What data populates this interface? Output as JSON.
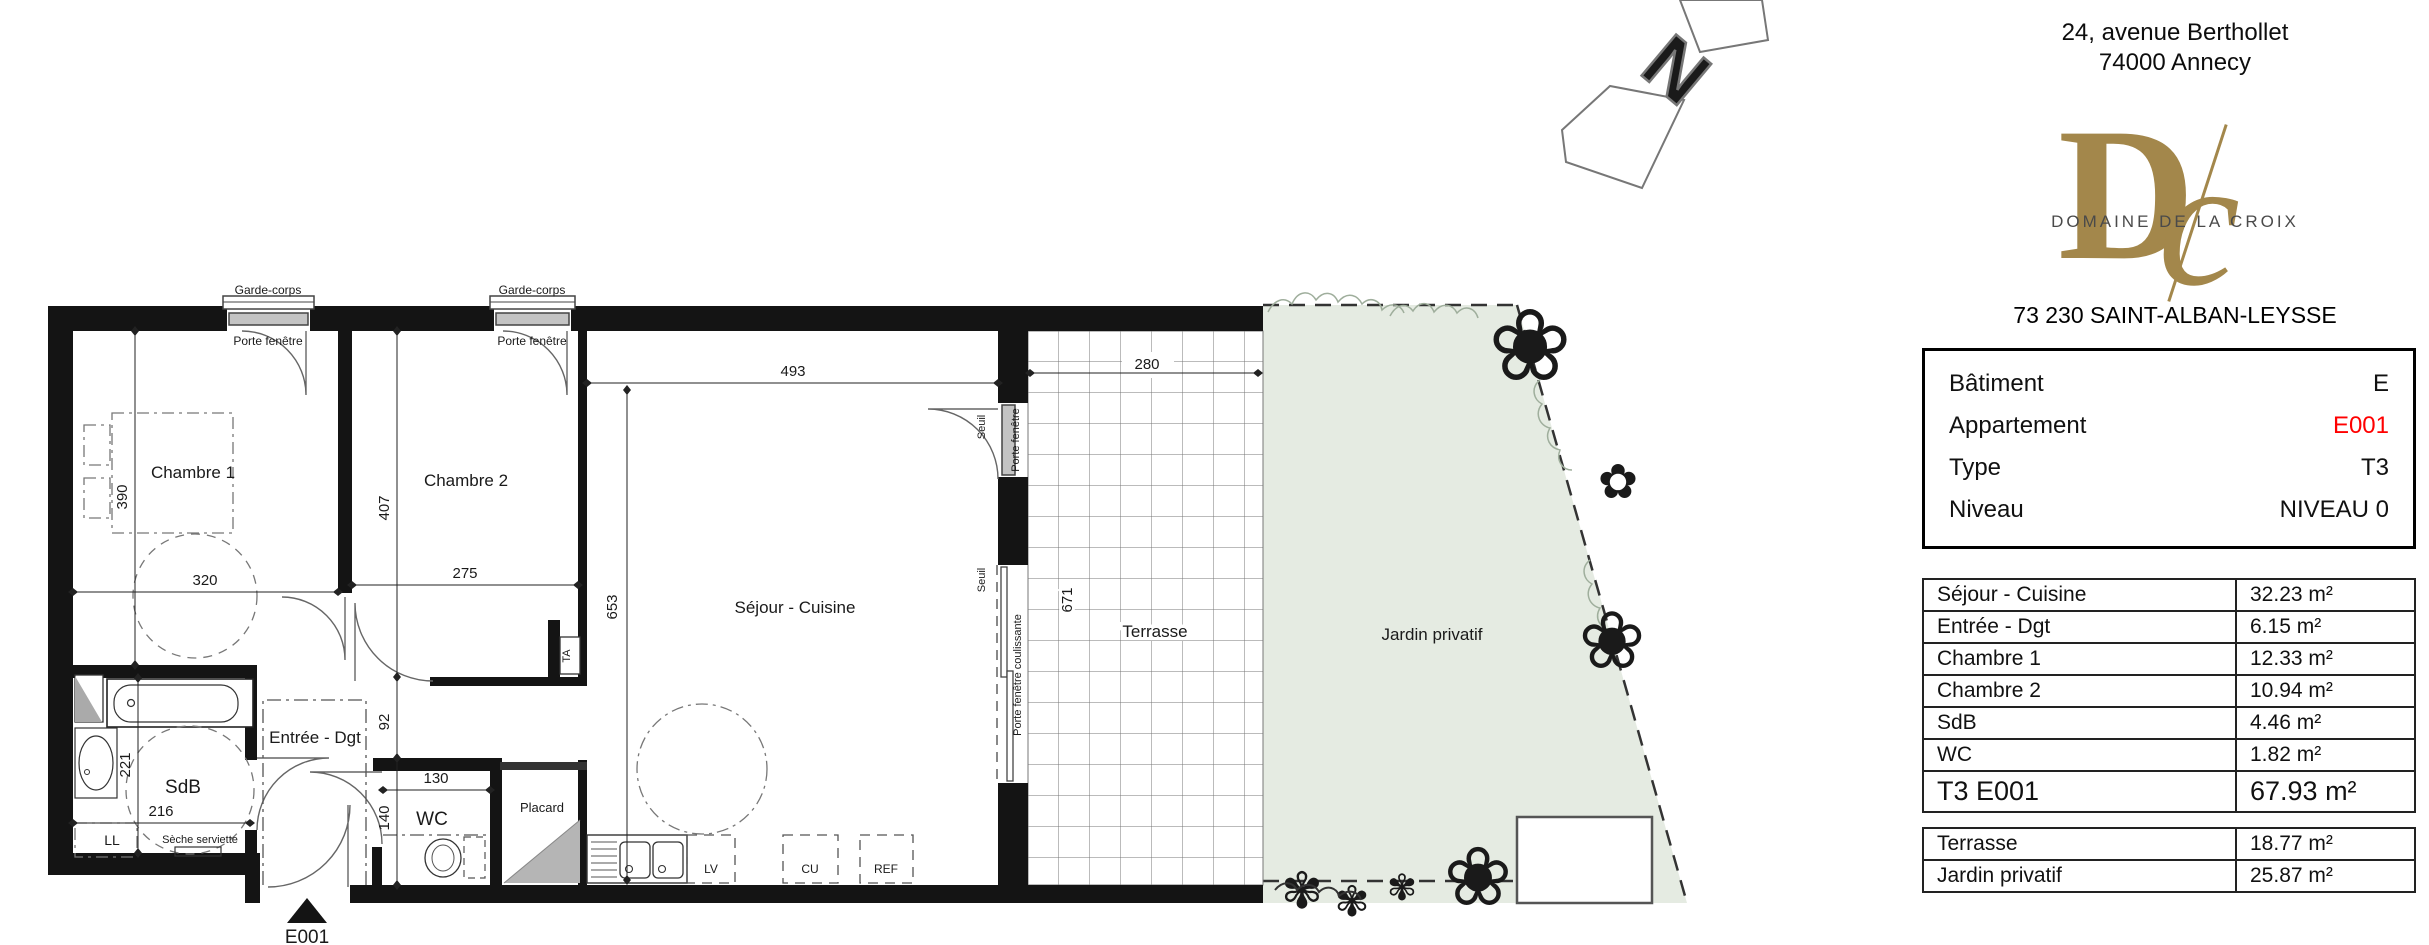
{
  "address": {
    "line1": "24, avenue Berthollet",
    "line2": "74000 Annecy"
  },
  "logo": {
    "monogram_d": "D",
    "monogram_c": "c",
    "name": "DOMAINE DE LA CROIX"
  },
  "city_line": "73 230 SAINT-ALBAN-LEYSSE",
  "north_letter": "N",
  "info": {
    "rows": [
      {
        "label": "Bâtiment",
        "value": "E"
      },
      {
        "label": "Appartement",
        "value": "E001"
      },
      {
        "label": "Type",
        "value": "T3"
      },
      {
        "label": "Niveau",
        "value": "NIVEAU 0"
      }
    ]
  },
  "areas": {
    "rows": [
      {
        "label": "Séjour - Cuisine",
        "value": "32.23 m²"
      },
      {
        "label": "Entrée - Dgt",
        "value": "6.15 m²"
      },
      {
        "label": "Chambre 1",
        "value": "12.33 m²"
      },
      {
        "label": "Chambre 2",
        "value": "10.94 m²"
      },
      {
        "label": "SdB",
        "value": "4.46 m²"
      },
      {
        "label": "WC",
        "value": "1.82 m²"
      }
    ],
    "total": {
      "label": "T3 E001",
      "value": "67.93 m²"
    }
  },
  "outdoor": {
    "rows": [
      {
        "label": "Terrasse",
        "value": "18.77 m²"
      },
      {
        "label": "Jardin privatif",
        "value": "25.87 m²"
      }
    ]
  },
  "plan": {
    "rooms": {
      "chambre1": "Chambre 1",
      "chambre2": "Chambre 2",
      "sejour": "Séjour - Cuisine",
      "entree": "Entrée - Dgt",
      "sdb": "SdB",
      "wc": "WC",
      "terrasse": "Terrasse",
      "jardin": "Jardin privatif",
      "placard": "Placard"
    },
    "dims": {
      "d493": "493",
      "d280": "280",
      "d320": "320",
      "d275": "275",
      "d216": "216",
      "d130": "130",
      "d390": "390",
      "d221": "221",
      "d407": "407",
      "d92": "92",
      "d140": "140",
      "d653": "653",
      "d671": "671"
    },
    "labels": {
      "garde_corps": "Garde-corps",
      "porte_fenetre": "Porte fenêtre",
      "porte_fenetre_coulissante": "Porte fenêtre coulissante",
      "seuil": "Seuil",
      "ta": "TA",
      "ll": "LL",
      "seche_serviette": "Sèche serviette",
      "lv": "LV",
      "cu": "CU",
      "ref": "REF",
      "entry_code": "E001"
    }
  },
  "colors": {
    "wall": "#141414",
    "accent_red": "#ff0000",
    "logo_gold": "#a3874b",
    "garden_fill": "#e5ebe2",
    "window_fill": "#c4c4c4",
    "placard_gray": "#b5b5b5"
  }
}
